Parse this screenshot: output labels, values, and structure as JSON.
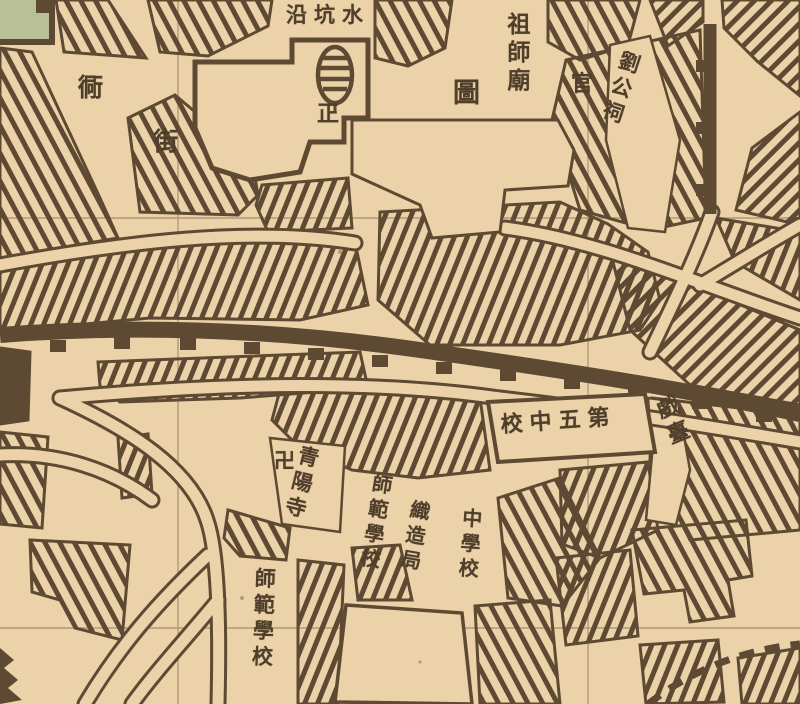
{
  "map": {
    "title": "historical-chinese-city-map-sheet",
    "labels": {
      "shuikengyan": "沿坑水",
      "tong": "衕",
      "jie": "街",
      "zheng": "正",
      "zushimiao": "祖師廟",
      "tu": "圖",
      "guan": "官",
      "liugongci": "劉公祠",
      "diwuzhongxiao": "校中五第",
      "xitai": "戲臺",
      "wan": "卍",
      "qingyangsi": "青陽寺",
      "shifanxuexiao_1": "師範學校",
      "zhizaoju": "織造局",
      "zhongxuexiao": "中學校",
      "shifanxuexiao_2": "師範學校"
    },
    "colors": {
      "paper": "#ecd2a9",
      "ink": "#5e4a33",
      "grid_line": "#9a8062",
      "green_edge": "#b9bf96"
    }
  }
}
